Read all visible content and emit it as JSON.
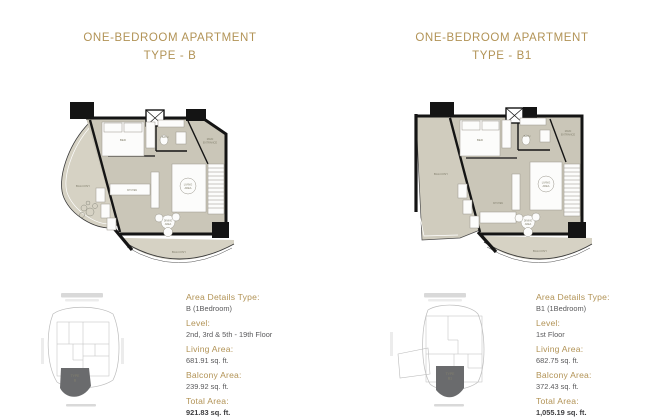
{
  "colors": {
    "gold": "#b29356",
    "text_dark": "#5a5a5c",
    "floor": "#cac6b8",
    "balcony": "#d6d2c4",
    "wall": "#141414",
    "keyplan_line": "#bcbcbc",
    "keyplan_unit_fill": "#6a6b6d"
  },
  "panels": [
    {
      "title_line1": "ONE-BEDROOM APARTMENT",
      "title_line2": "TYPE - B",
      "plan": {
        "bed": "BED",
        "bath": "BATH",
        "main_entrance_1": "MAIN",
        "main_entrance_2": "ENTRANCE",
        "living_1": "LIVING",
        "living_2": "AREA",
        "kitchen": "KITCHEN",
        "dining_1": "DINING",
        "dining_2": "AREA",
        "balcony_side": "BALCONY",
        "balcony_bottom": "BALCONY"
      },
      "keyplan": {
        "unit_line1": "TYPE",
        "unit_line2": "B"
      },
      "details": [
        {
          "label": "Area Details Type:",
          "value": "B (1Bedroom)"
        },
        {
          "label": "Level:",
          "value": "2nd, 3rd & 5th - 19th Floor"
        },
        {
          "label": "Living Area:",
          "value": "681.91 sq. ft."
        },
        {
          "label": "Balcony Area:",
          "value": "239.92 sq. ft."
        },
        {
          "label": "Total Area:",
          "value": "921.83 sq. ft."
        }
      ]
    },
    {
      "title_line1": "ONE-BEDROOM APARTMENT",
      "title_line2": "TYPE - B1",
      "plan": {
        "bed": "BED",
        "bath": "BATH",
        "main_entrance_1": "MAIN",
        "main_entrance_2": "ENTRANCE",
        "living_1": "LIVING",
        "living_2": "AREA",
        "kitchen": "KITCHEN",
        "dining_1": "DINING",
        "dining_2": "AREA",
        "balcony_side": "BALCONY",
        "balcony_bottom": "BALCONY"
      },
      "keyplan": {
        "unit_line1": "TYPE",
        "unit_line2": "B1"
      },
      "details": [
        {
          "label": "Area Details Type:",
          "value": "B1 (1Bedroom)"
        },
        {
          "label": "Level:",
          "value": "1st Floor"
        },
        {
          "label": "Living Area:",
          "value": "682.75 sq. ft."
        },
        {
          "label": "Balcony Area:",
          "value": "372.43 sq. ft."
        },
        {
          "label": "Total Area:",
          "value": "1,055.19 sq. ft."
        }
      ]
    }
  ]
}
